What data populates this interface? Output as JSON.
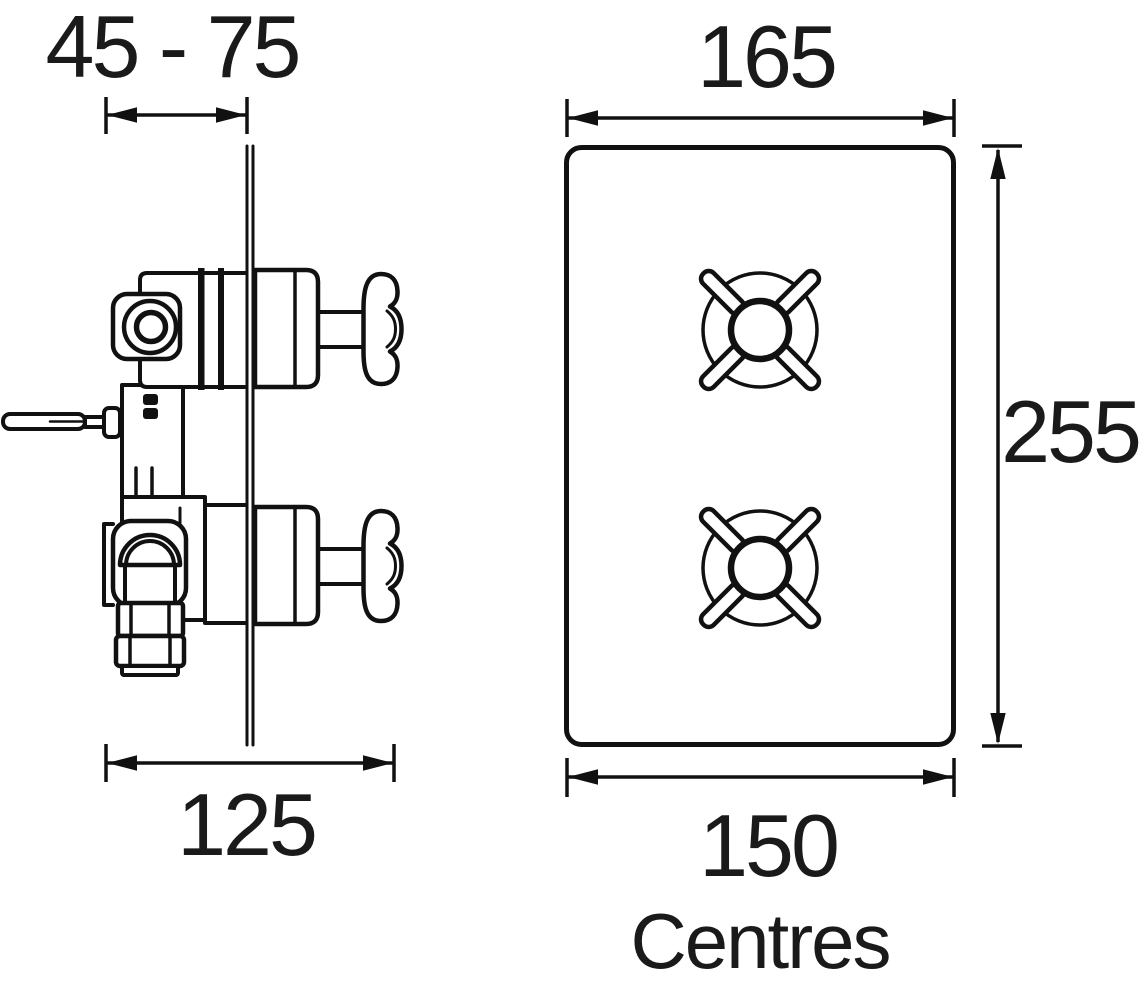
{
  "diagram": {
    "description": "Concealed thermostatic twin shower valve installation drawing, side view and front face-plate view",
    "dimensions": {
      "depth_range": "45 - 75",
      "overall_depth": "125",
      "plate_width": "165",
      "plate_height": "255",
      "centres_width": "150",
      "centres_label": "Centres"
    },
    "colors": {
      "line": "#111111",
      "text": "#1a1a1a",
      "background": "#ffffff"
    }
  }
}
